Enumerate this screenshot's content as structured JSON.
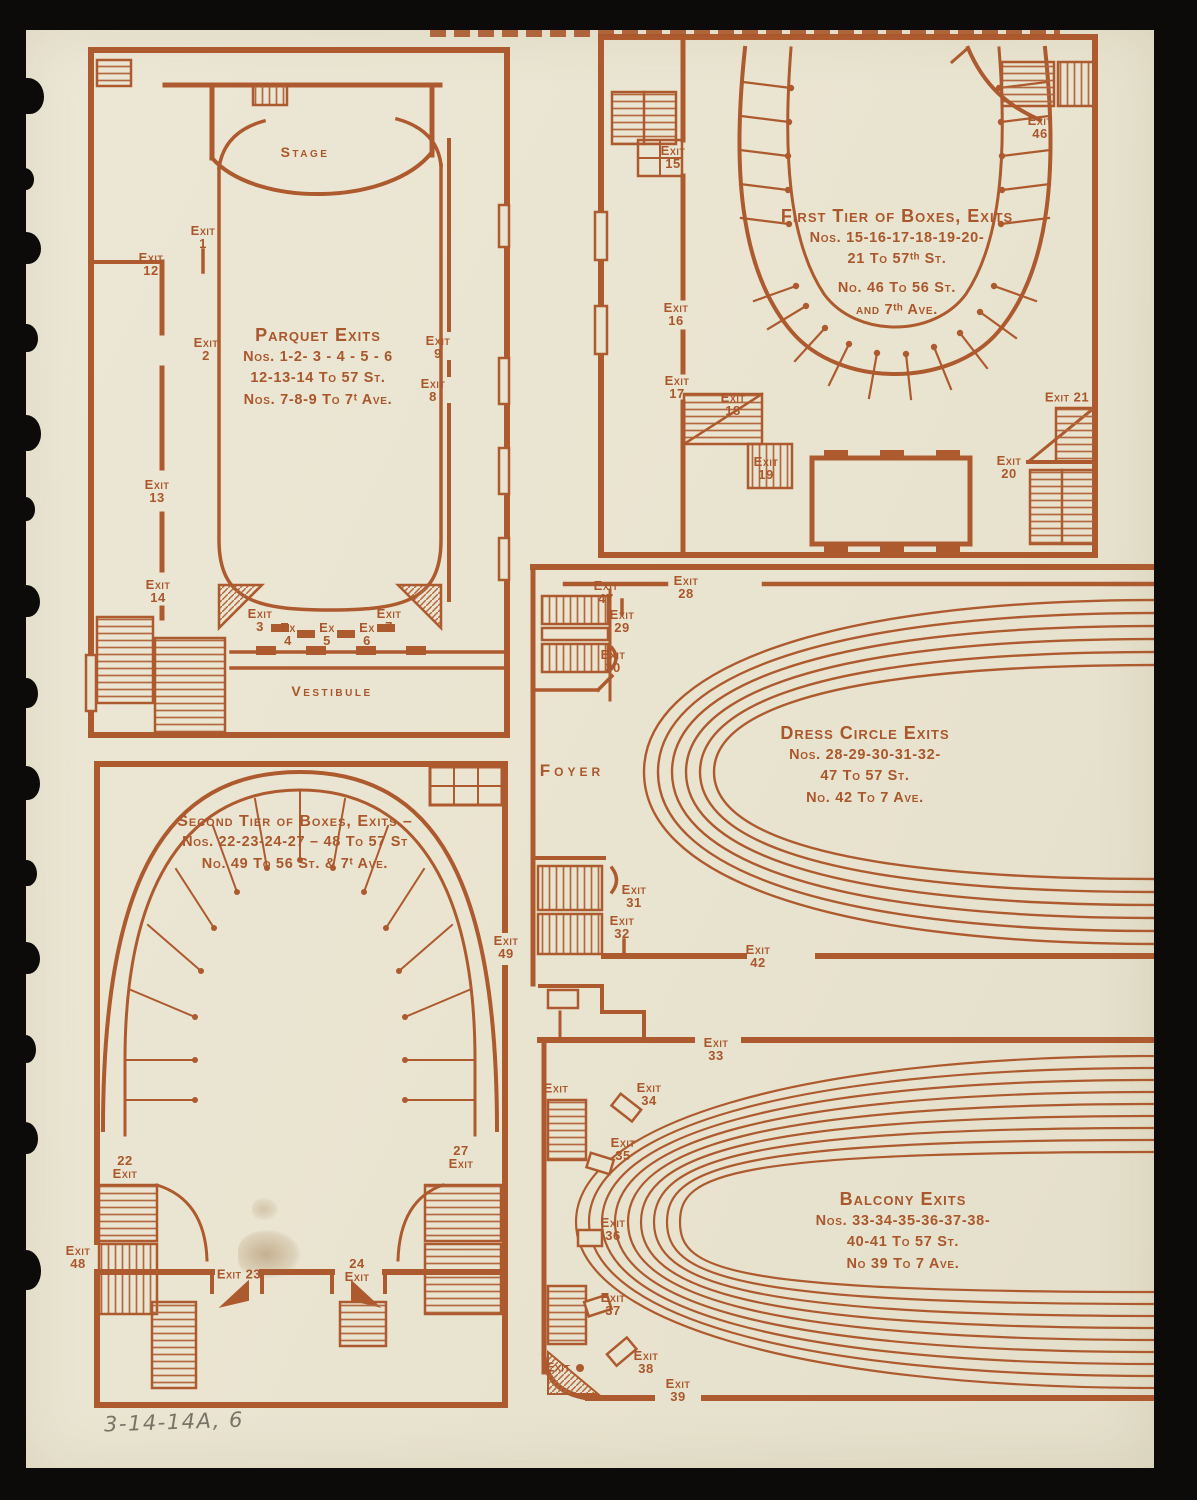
{
  "page": {
    "pencil_note": "3-14-14A, 6"
  },
  "colors": {
    "ink": "#a9572b",
    "paper": "#e9e4d0",
    "background": "#0c0b09",
    "pencil": "#7b7266"
  },
  "plans": {
    "parquet": {
      "stage": "Stage",
      "vestibule": "Vestibule",
      "title": "Parquet Exits",
      "lines": [
        "Nos. 1-2- 3 - 4 - 5 - 6",
        "12-13-14  To 57 St.",
        "Nos. 7-8-9  To 7ᵗ Ave."
      ],
      "exits": {
        "e1": {
          "a": "Exit",
          "b": "1"
        },
        "e2": {
          "a": "Exit",
          "b": "2"
        },
        "e3": {
          "a": "Exit",
          "b": "3"
        },
        "e4": {
          "a": "Ex",
          "b": "4"
        },
        "e5": {
          "a": "Ex",
          "b": "5"
        },
        "e6": {
          "a": "Ex",
          "b": "6"
        },
        "e7": {
          "a": "Exit",
          "b": "7"
        },
        "e8": {
          "a": "Exit",
          "b": "8"
        },
        "e9": {
          "a": "Exit",
          "b": "9"
        },
        "e12": {
          "a": "Exit",
          "b": "12"
        },
        "e13": {
          "a": "Exit",
          "b": "13"
        },
        "e14": {
          "a": "Exit",
          "b": "14"
        }
      }
    },
    "first_tier": {
      "title": "First Tier of Boxes, Exits",
      "lines": [
        "Nos. 15-16-17-18-19-20-",
        "21 To 57ᵗʰ St."
      ],
      "lines2": [
        "No.  46 To 56 St.",
        "and 7ᵗʰ Ave."
      ],
      "exits": {
        "e15": {
          "a": "Exit",
          "b": "15"
        },
        "e16": {
          "a": "Exit",
          "b": "16"
        },
        "e17": {
          "a": "Exit",
          "b": "17"
        },
        "e18": {
          "a": "Exit",
          "b": "18"
        },
        "e19": {
          "a": "Exit",
          "b": "19"
        },
        "e20": {
          "a": "Exit",
          "b": "20"
        },
        "e21": {
          "a": "Exit 21"
        },
        "e46": {
          "a": "Exit",
          "b": "46"
        }
      }
    },
    "dress_circle": {
      "foyer": "Foyer",
      "title": "Dress Circle Exits",
      "lines": [
        "Nos. 28-29-30-31-32-",
        "47 To 57 St.",
        "No. 42 To  7 Ave."
      ],
      "exits": {
        "e28": {
          "a": "Exit",
          "b": "28"
        },
        "e29": {
          "a": "Exit",
          "b": "29"
        },
        "e30": {
          "a": "Exit",
          "b": "30"
        },
        "e31": {
          "a": "Exit",
          "b": "31"
        },
        "e32": {
          "a": "Exit",
          "b": "32"
        },
        "e42": {
          "a": "Exit",
          "b": "42"
        },
        "e47": {
          "a": "Exit",
          "b": "47"
        }
      }
    },
    "second_tier": {
      "title": "Second Tier of Boxes,  Exits –",
      "lines": [
        "Nos. 22-23-24-27 – 48 To 57 St",
        "No.  49 To 56 St. & 7ᵗ Ave."
      ],
      "exits": {
        "e22": {
          "a": "22",
          "b": "Exit"
        },
        "e23": {
          "a": "Exit 23"
        },
        "e24": {
          "a": "24",
          "b": "Exit"
        },
        "e27": {
          "a": "27",
          "b": "Exit"
        },
        "e48": {
          "a": "Exit",
          "b": "48"
        },
        "e49": {
          "a": "Exit",
          "b": "49"
        }
      }
    },
    "balcony": {
      "title": "Balcony Exits",
      "lines": [
        "Nos. 33-34-35-36-37-38-",
        "40-41 To 57 St.",
        "No 39 To 7 Ave."
      ],
      "exits": {
        "e33": {
          "a": "Exit",
          "b": "33"
        },
        "e34": {
          "a": "Exit",
          "b": "34"
        },
        "e35": {
          "a": "Exit",
          "b": "35"
        },
        "e36": {
          "a": "Exit",
          "b": "36"
        },
        "e37": {
          "a": "Exit",
          "b": "37"
        },
        "e38": {
          "a": "Exit",
          "b": "38"
        },
        "e39": {
          "a": "Exit",
          "b": "39"
        },
        "side": {
          "a": "Exit"
        },
        "corner": {
          "a": "Exit"
        }
      }
    }
  }
}
